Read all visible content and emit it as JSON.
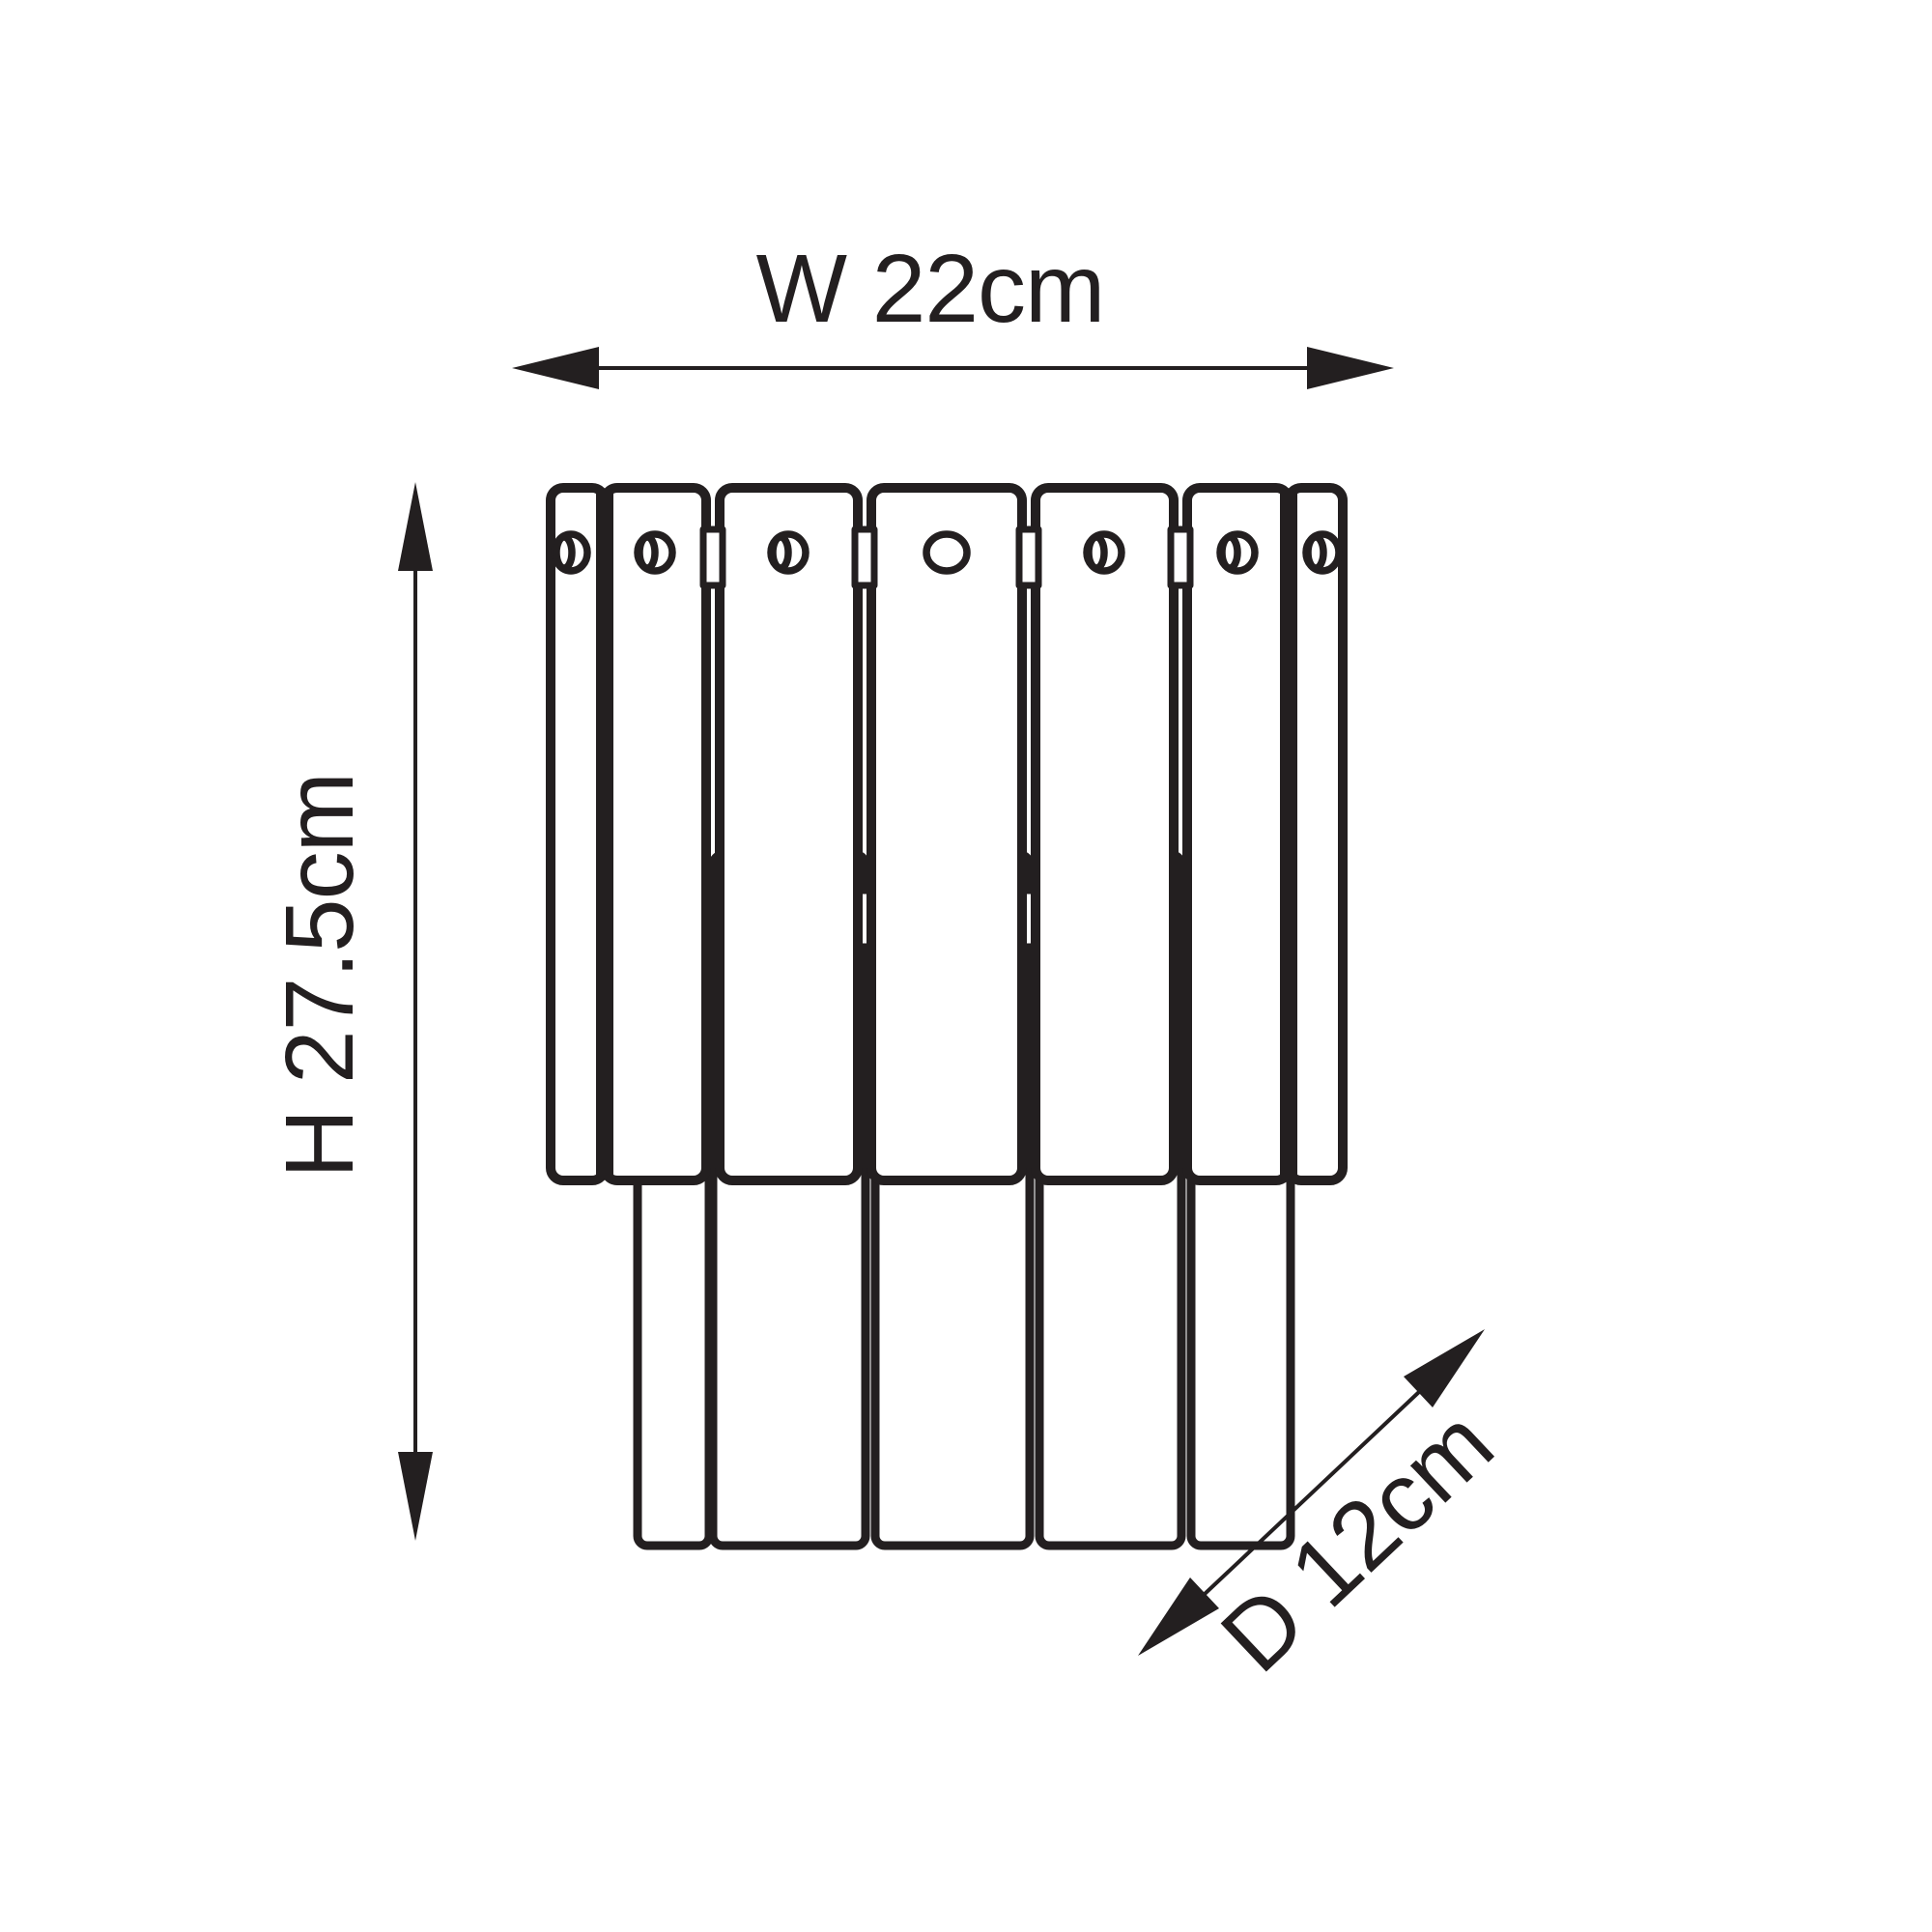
{
  "drawing": {
    "type": "technical-dimension-diagram",
    "subject": "tiered wall light fixture, front elevation",
    "background_color": "#ffffff",
    "line_color": "#231f20",
    "labels": {
      "width": "W 22cm",
      "height": "H 27.5cm",
      "depth": "D 12cm"
    },
    "fixture": {
      "front_slat_count": 7,
      "rear_slat_count": 5,
      "holes_per_front_slat": 1
    }
  }
}
